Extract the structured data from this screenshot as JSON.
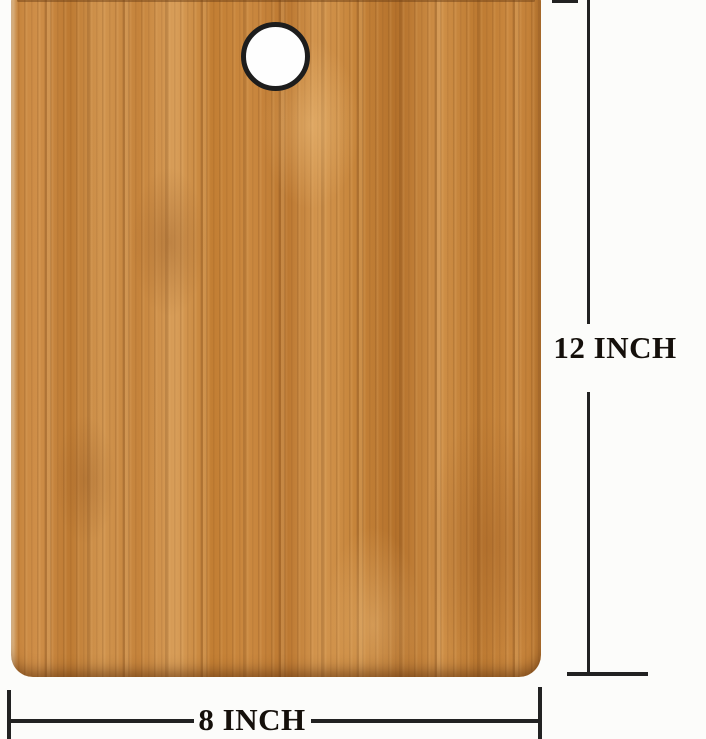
{
  "background_color": "#fcfcfa",
  "product": {
    "name": "bamboo cutting board",
    "wood_base_color": "#c9873e",
    "wood_dark_color": "#b4712b",
    "wood_light_color": "#d89e59",
    "hole_ring_color": "#1d1d1d",
    "hole_fill_color": "#fefefe"
  },
  "annotations": {
    "line_color": "#222222",
    "text_color": "#15100b",
    "height_label": "12 INCH",
    "width_label": "8 INCH"
  }
}
